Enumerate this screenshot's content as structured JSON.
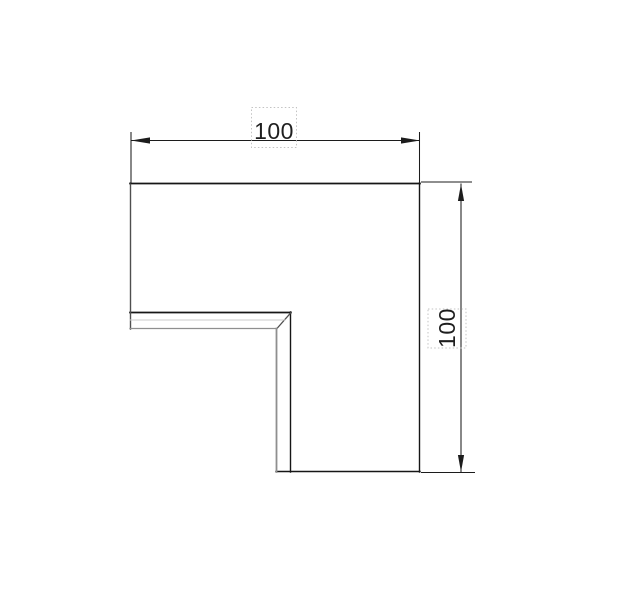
{
  "palette": {
    "background": "#ffffff",
    "edge_dark": "#161616",
    "edge_medium": "#4f4f4f",
    "edge_gray": "#8f8f8f",
    "edge_light": "#cbcbcb",
    "dimension_line": "#1c1c1c",
    "dimension_text": "#1f1f1f",
    "selection_box": "#c3c3c3"
  },
  "icons": {
    "dimension_arrowhead": "filled-triangle"
  },
  "drawing": {
    "dimensions": {
      "horizontal": {
        "value": "100"
      },
      "vertical": {
        "value": "100"
      }
    }
  }
}
